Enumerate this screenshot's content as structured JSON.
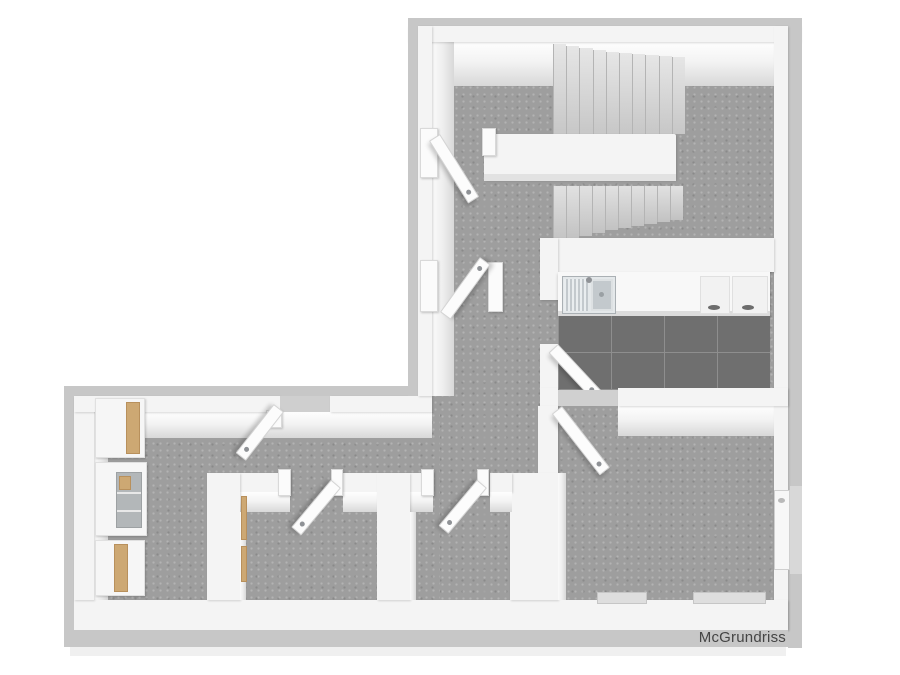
{
  "watermark": {
    "label": "McGrundriss"
  },
  "palette": {
    "background": "#ffffff",
    "wall_top": "#f4f4f4",
    "wall_band": "#c7c7c7",
    "wall_face_dark": "#d8d8d8",
    "floor": "#9e9e9e",
    "tile": "#6f6f6f",
    "grout": "#8e8e8e",
    "wood": "#cda873",
    "niche": "#b3b7b9",
    "steel_light": "#e4e8ea",
    "steel_dark": "#c3c9cd",
    "handle": "#8f9296",
    "watermark_ink": "#454545"
  },
  "stairs": {
    "upper_steps": 10,
    "lower_steps": 10
  },
  "kitchen": {
    "base_units": 2,
    "fixtures": [
      "sink-drainboard",
      "sink-basin",
      "faucet"
    ],
    "tile_grid": "4x2"
  },
  "doors": {
    "open_leaves": 7
  },
  "windows": {
    "count": 3
  },
  "closets": {
    "units": 3
  }
}
